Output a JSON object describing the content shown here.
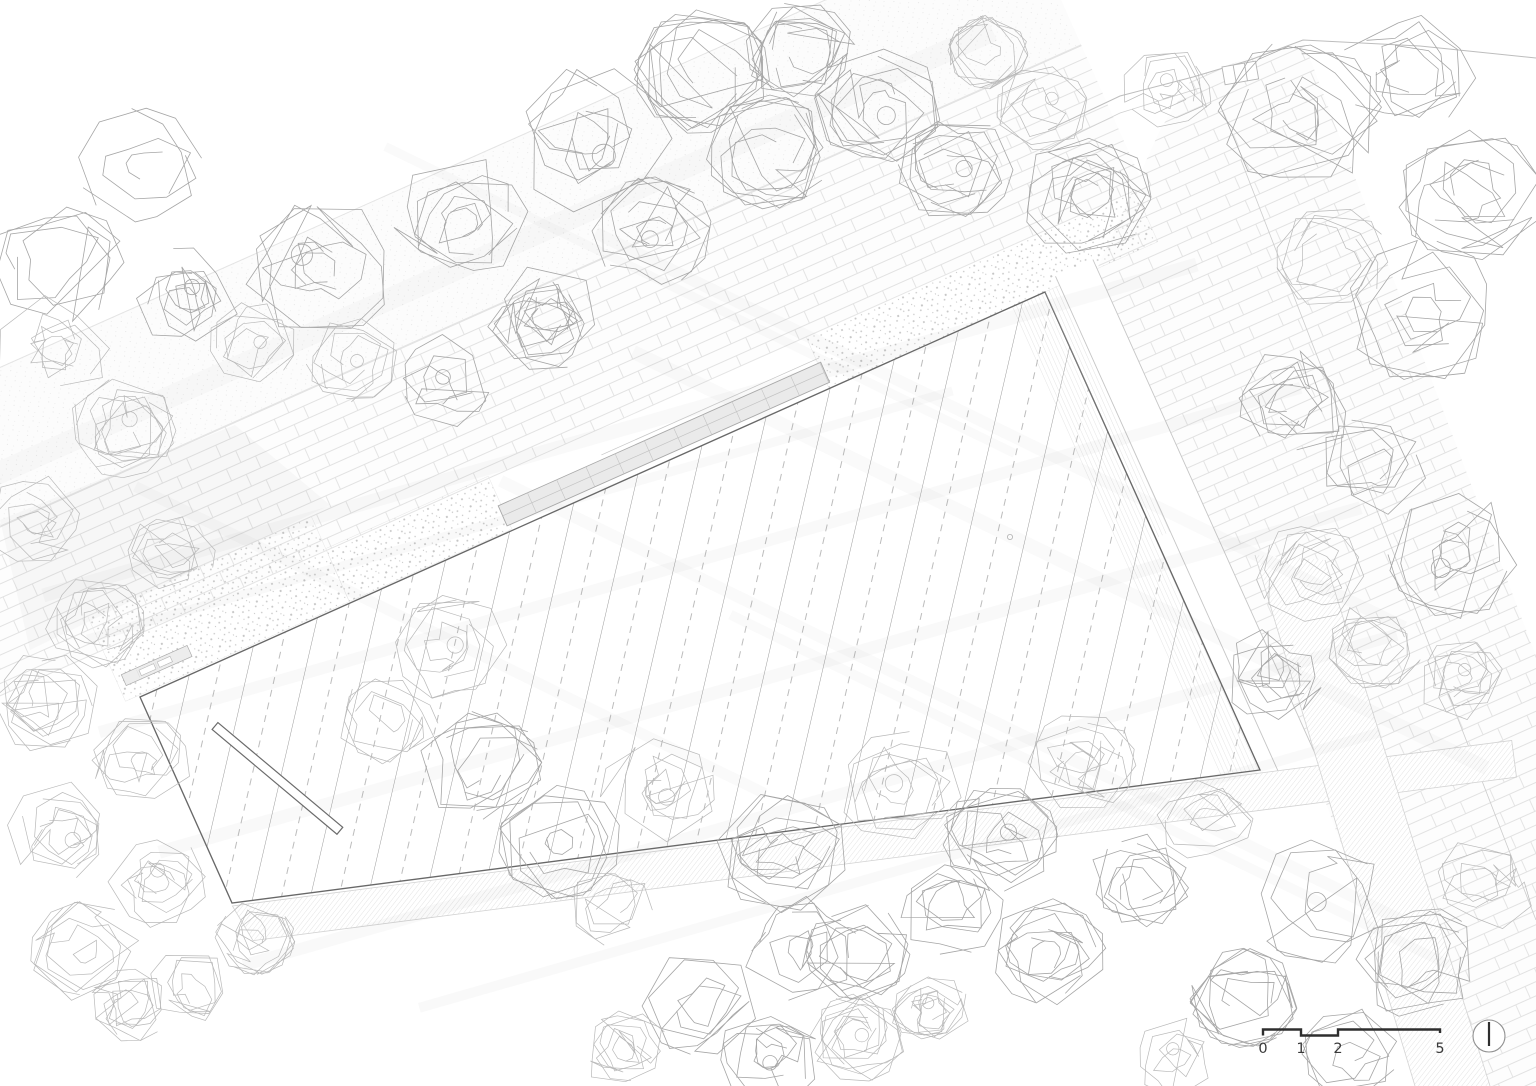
{
  "meta": {
    "kind": "architectural-site-roof-plan",
    "width": 1536,
    "height": 1086
  },
  "colors": {
    "paper": "#ffffff",
    "roof_outline": "#686868",
    "hatch_solid": "#9c9c9c",
    "hatch_dash": "#b5b5b5",
    "fine_hatch": "#c9c9c9",
    "brick_line": "#e2e2e2",
    "gravel_dot": "#c6c6c6",
    "tree_stroke": "#a6a6a6",
    "tree_stroke_light": "#b9b9b9",
    "walk_line": "#c6c6c6",
    "faint_line": "#e4e4e4",
    "shadow_tint": "#8a8a8a",
    "dark_ink": "#2e2e2e",
    "north_circle": "#909090"
  },
  "scale_bar": {
    "labels": [
      "0",
      "1",
      "2",
      "5"
    ],
    "marks_x": [
      1263,
      1301,
      1338,
      1440
    ],
    "bar_y_high": 1029.5,
    "bar_y_low": 1035.5,
    "tick_end_y": 1033
  },
  "north_indicator": {
    "cx": 1489,
    "cy": 1036,
    "r": 16,
    "needle_y1": 1022,
    "needle_y2": 1046
  },
  "roof": {
    "outline": [
      [
        140,
        697
      ],
      [
        1045,
        292
      ],
      [
        1260,
        770
      ],
      [
        232,
        903
      ]
    ],
    "hatch": {
      "angle_deg": 13,
      "period": 56,
      "dash": [
        7,
        6
      ]
    },
    "edge_strip_w": 38,
    "vent": [
      1010,
      537,
      2.6
    ]
  },
  "bench": {
    "x": 215,
    "y": 726,
    "len": 163,
    "w": 9,
    "angle_deg": 40
  },
  "corridor": {
    "origin": [
      140,
      697
    ],
    "angle_deg": -24,
    "brick_v": [
      58,
      213
    ],
    "road_v": [
      213,
      358
    ],
    "extent_t": [
      -620,
      1125
    ],
    "gravel_zones": [
      [
        -15,
        230,
        2,
        95
      ],
      [
        230,
        408,
        2,
        60
      ],
      [
        755,
        1115,
        2,
        58
      ]
    ],
    "shadow_band": [
      -300,
      1100,
      250,
      274
    ],
    "soft_wedge": [
      [
        0,
        520
      ],
      [
        235,
        425
      ],
      [
        330,
        505
      ],
      [
        30,
        650
      ]
    ],
    "bar": {
      "t": [
        405,
        758
      ],
      "v": [
        7,
        29
      ],
      "mid_v": 18,
      "divider_step": 32,
      "top_line_v": 33.5,
      "top_line_t": [
        520,
        758
      ]
    },
    "steps": {
      "rects": [
        [
          -8,
          64,
          16,
          28
        ],
        [
          6,
          40,
          18,
          26
        ]
      ],
      "white_rects": [
        [
          10,
          26,
          19,
          25
        ],
        [
          30,
          44,
          19,
          25
        ]
      ]
    }
  },
  "right_area": {
    "brick_poly": [
      [
        1097,
        269
      ],
      [
        1160,
        130
      ],
      [
        1193,
        77
      ],
      [
        1303,
        40
      ],
      [
        1536,
        656
      ],
      [
        1536,
        1086
      ],
      [
        1430,
        1086
      ],
      [
        1310,
        760
      ],
      [
        1253,
        615
      ],
      [
        1170,
        457
      ]
    ],
    "walkway": {
      "w_lines": [
        16,
        57
      ],
      "t": [
        -10,
        545
      ],
      "hatch_w": [
        0,
        16
      ],
      "hatch_t": [
        0,
        270
      ]
    },
    "boundary_line": [
      [
        1241,
        160
      ],
      [
        1536,
        920
      ]
    ],
    "side_path": [
      [
        1255,
        555
      ],
      [
        1325,
        560
      ],
      [
        1490,
        1086
      ],
      [
        1415,
        1086
      ]
    ]
  },
  "bottom_walkway": {
    "w": [
      3,
      40
    ],
    "t": [
      0,
      1290
    ],
    "shear": 16
  },
  "road_curve": {
    "main": [
      [
        1048,
        130
      ],
      [
        1120,
        96
      ],
      [
        1193,
        77
      ],
      [
        1250,
        60
      ],
      [
        1303,
        40
      ],
      [
        1420,
        46
      ],
      [
        1536,
        58
      ]
    ],
    "secondary": [
      [
        1040,
        152
      ],
      [
        1120,
        113
      ],
      [
        1200,
        88
      ]
    ]
  },
  "cells_rect": {
    "x": 1222,
    "y": 67,
    "w": 34,
    "h": 18,
    "angle": -10,
    "cells": 3
  },
  "shadow_bands": {
    "family_a_deg": -16,
    "family_b_deg": 26,
    "a": [
      [
        620,
        430,
        1200,
        14
      ],
      [
        700,
        560,
        1250,
        12
      ],
      [
        760,
        680,
        1250,
        13
      ],
      [
        820,
        800,
        1200,
        12
      ],
      [
        520,
        515,
        900,
        9
      ],
      [
        900,
        870,
        1000,
        10
      ]
    ],
    "b": [
      [
        1000,
        430,
        900,
        12
      ],
      [
        1060,
        560,
        950,
        14
      ],
      [
        950,
        700,
        1000,
        12
      ],
      [
        1090,
        790,
        800,
        10
      ],
      [
        450,
        640,
        700,
        11
      ],
      [
        700,
        300,
        700,
        9
      ]
    ]
  },
  "trees": [
    [
      140,
      165,
      62,
      0
    ],
    [
      58,
      262,
      66,
      0
    ],
    [
      185,
      298,
      55,
      0
    ],
    [
      320,
      268,
      76,
      0
    ],
    [
      462,
      222,
      72,
      0
    ],
    [
      590,
      138,
      82,
      0
    ],
    [
      702,
      72,
      68,
      0
    ],
    [
      800,
      52,
      55,
      0
    ],
    [
      768,
      152,
      62,
      0
    ],
    [
      652,
      232,
      60,
      0
    ],
    [
      545,
      318,
      58,
      0
    ],
    [
      438,
      382,
      52,
      0
    ],
    [
      352,
      360,
      46,
      1
    ],
    [
      252,
      342,
      44,
      1
    ],
    [
      878,
      105,
      64,
      0
    ],
    [
      955,
      168,
      58,
      0
    ],
    [
      1042,
      108,
      46,
      1
    ],
    [
      1085,
      195,
      66,
      0
    ],
    [
      1168,
      88,
      46,
      1
    ],
    [
      988,
      52,
      40,
      1
    ],
    [
      1300,
      115,
      82,
      0
    ],
    [
      1408,
      72,
      68,
      0
    ],
    [
      1470,
      196,
      72,
      0
    ],
    [
      1424,
      312,
      78,
      0
    ],
    [
      1332,
      258,
      56,
      1
    ],
    [
      1290,
      398,
      68,
      0
    ],
    [
      1372,
      470,
      58,
      0
    ],
    [
      1456,
      556,
      68,
      0
    ],
    [
      1310,
      572,
      54,
      1
    ],
    [
      1272,
      672,
      52,
      0
    ],
    [
      1375,
      645,
      48,
      1
    ],
    [
      1460,
      680,
      44,
      1
    ],
    [
      55,
      348,
      58,
      1
    ],
    [
      122,
      428,
      54,
      1
    ],
    [
      35,
      522,
      54,
      1
    ],
    [
      172,
      552,
      44,
      1
    ],
    [
      95,
      622,
      50,
      1
    ],
    [
      45,
      702,
      55,
      1
    ],
    [
      142,
      762,
      50,
      1
    ],
    [
      62,
      832,
      55,
      1
    ],
    [
      158,
      882,
      50,
      1
    ],
    [
      85,
      952,
      55,
      1
    ],
    [
      192,
      988,
      44,
      1
    ],
    [
      255,
      938,
      40,
      1
    ],
    [
      130,
      1005,
      40,
      1
    ],
    [
      452,
      648,
      58,
      1
    ],
    [
      390,
      722,
      52,
      1
    ],
    [
      480,
      768,
      62,
      0
    ],
    [
      560,
      842,
      62,
      0
    ],
    [
      658,
      792,
      58,
      1
    ],
    [
      782,
      852,
      66,
      0
    ],
    [
      800,
      948,
      58,
      0
    ],
    [
      900,
      788,
      62,
      1
    ],
    [
      1000,
      838,
      58,
      0
    ],
    [
      1082,
      762,
      54,
      1
    ],
    [
      952,
      902,
      58,
      0
    ],
    [
      858,
      952,
      52,
      0
    ],
    [
      1048,
      952,
      58,
      0
    ],
    [
      1140,
      882,
      54,
      0
    ],
    [
      1205,
      818,
      48,
      1
    ],
    [
      615,
      905,
      45,
      1
    ],
    [
      700,
      1003,
      58,
      0
    ],
    [
      768,
      1058,
      52,
      0
    ],
    [
      625,
      1052,
      45,
      1
    ],
    [
      858,
      1038,
      48,
      1
    ],
    [
      1320,
      902,
      68,
      0
    ],
    [
      1418,
      962,
      62,
      0
    ],
    [
      1244,
      998,
      54,
      0
    ],
    [
      1350,
      1052,
      48,
      0
    ],
    [
      1484,
      882,
      54,
      1
    ],
    [
      1178,
      1058,
      44,
      1
    ],
    [
      930,
      1010,
      40,
      1
    ]
  ]
}
